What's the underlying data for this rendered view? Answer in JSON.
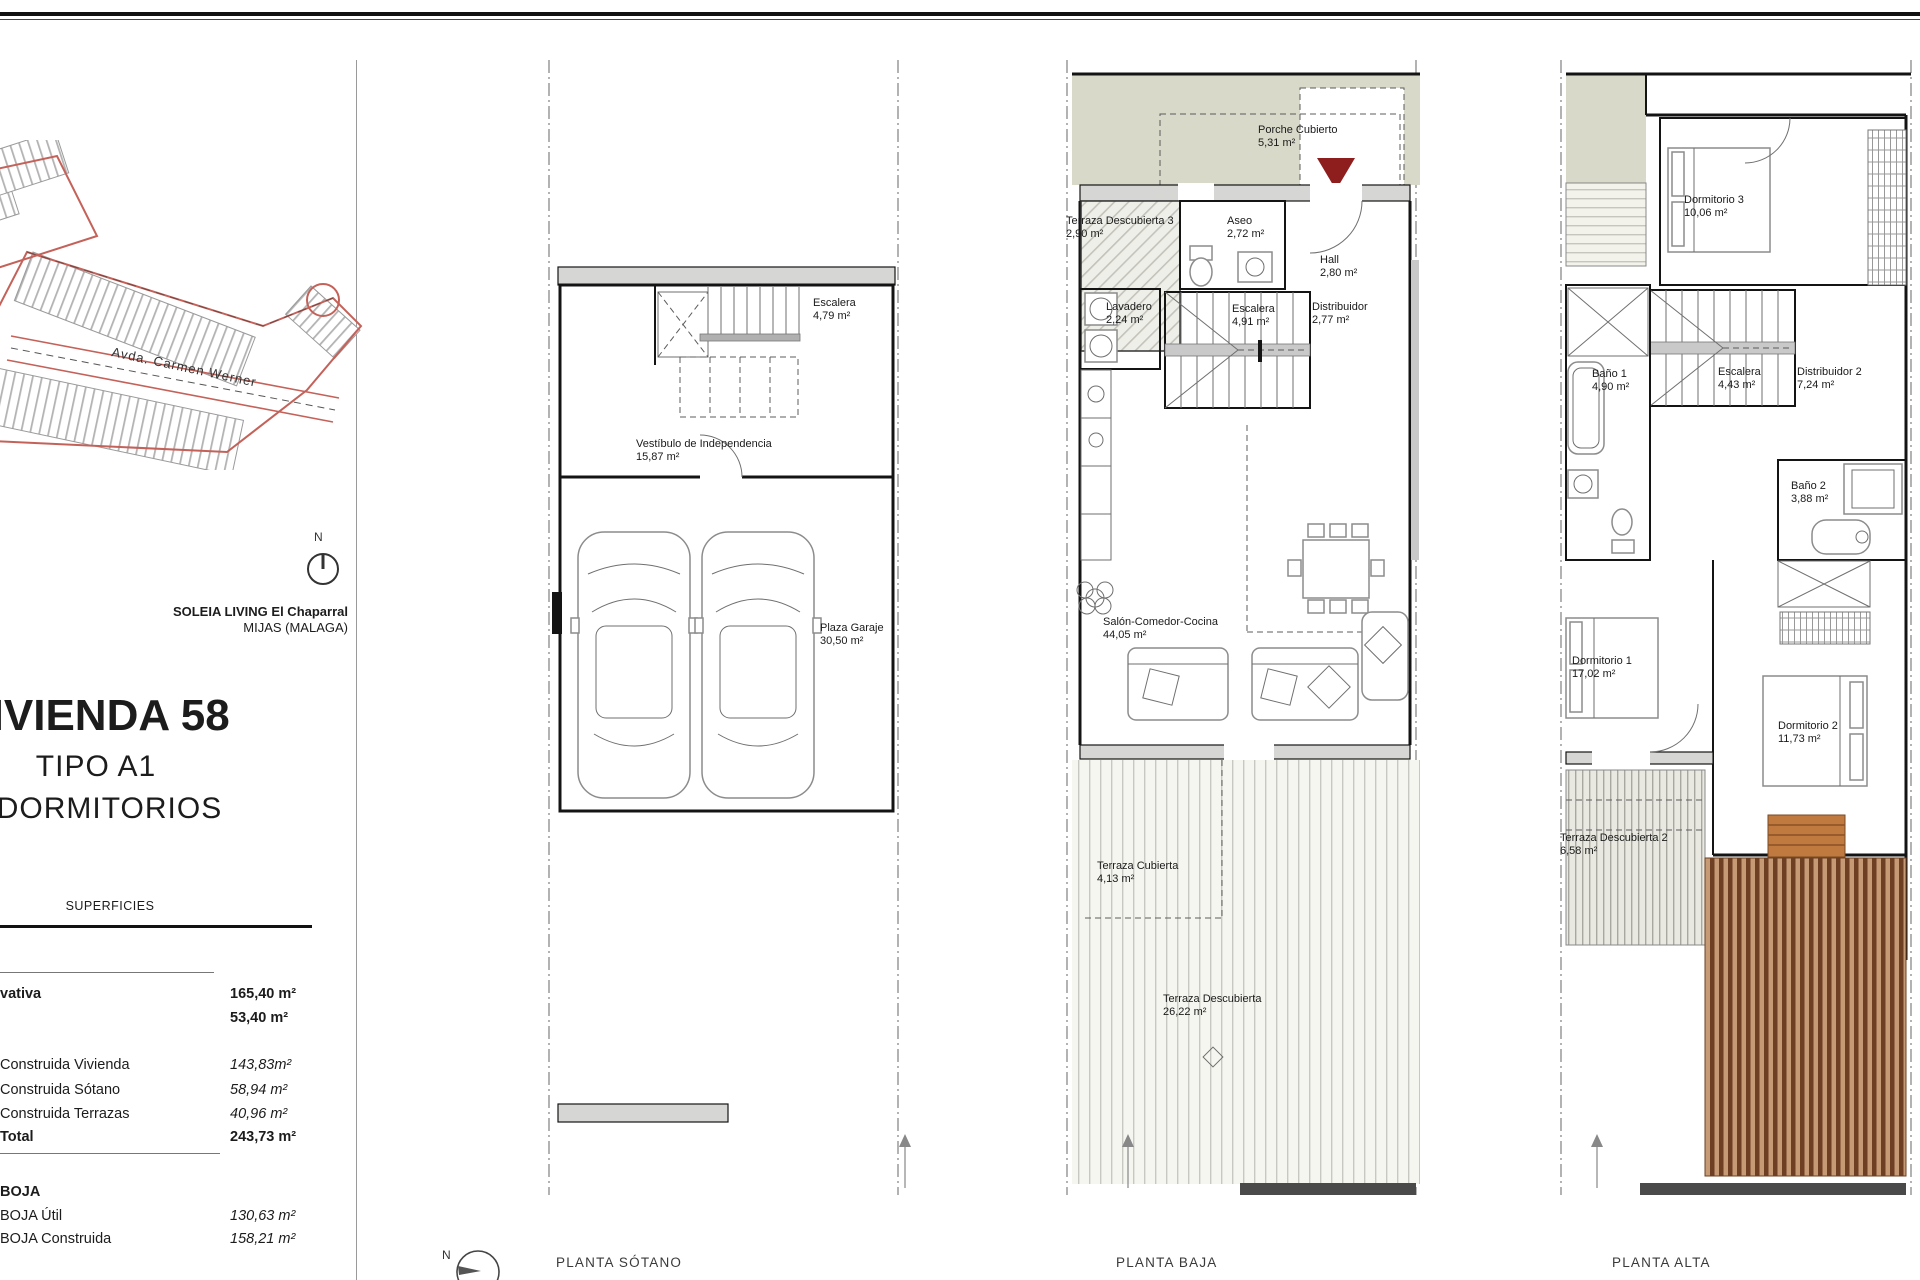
{
  "page": {
    "north_label": "N",
    "street_label": "Avda. Carmen Werner",
    "project_name": "SOLEIA LIVING El Chaparral",
    "project_location": "MIJAS (MALAGA)",
    "sheet_title": "VIVIENDA 58",
    "sheet_type": "TIPO A1",
    "sheet_bedrooms": "3 DORMITORIOS"
  },
  "superficies": {
    "header": "SUPERFICIES",
    "rows": [
      {
        "label": "vativa",
        "value": "165,40 m²"
      },
      {
        "label": "",
        "value": "53,40 m²"
      },
      {
        "label": "Construida Vivienda",
        "value": "143,83m²"
      },
      {
        "label": "Construida Sótano",
        "value": "58,94 m²"
      },
      {
        "label": "Construida Terrazas",
        "value": "40,96 m²"
      },
      {
        "label": "Total",
        "value": "243,73 m²"
      },
      {
        "label": "BOJA",
        "value": ""
      },
      {
        "label": "BOJA Útil",
        "value": "130,63 m²"
      },
      {
        "label": "BOJA Construida",
        "value": "158,21 m²"
      }
    ]
  },
  "plans": {
    "sotano": {
      "title": "PLANTA SÓTANO",
      "rooms": [
        {
          "name": "Escalera",
          "area": "4,79 m²"
        },
        {
          "name": "Vestíbulo de Independencia",
          "area": "15,87 m²"
        },
        {
          "name": "Plaza Garaje",
          "area": "30,50 m²"
        }
      ]
    },
    "baja": {
      "title": "PLANTA BAJA",
      "rooms": [
        {
          "name": "Porche Cubierto",
          "area": "5,31 m²"
        },
        {
          "name": "Terraza Descubierta 3",
          "area": "2,90 m²"
        },
        {
          "name": "Aseo",
          "area": "2,72 m²"
        },
        {
          "name": "Hall",
          "area": "2,80 m²"
        },
        {
          "name": "Lavadero",
          "area": "2,24 m²"
        },
        {
          "name": "Escalera",
          "area": "4,91 m²"
        },
        {
          "name": "Distribuidor",
          "area": "2,77 m²"
        },
        {
          "name": "Salón-Comedor-Cocina",
          "area": "44,05 m²"
        },
        {
          "name": "Terraza Cubierta",
          "area": "4,13 m²"
        },
        {
          "name": "Terraza Descubierta",
          "area": "26,22 m²"
        }
      ]
    },
    "alta": {
      "title": "PLANTA ALTA",
      "rooms": [
        {
          "name": "Dormitorio 3",
          "area": "10,06 m²"
        },
        {
          "name": "Baño 1",
          "area": "4,90 m²"
        },
        {
          "name": "Escalera",
          "area": "4,43 m²"
        },
        {
          "name": "Distribuidor 2",
          "area": "7,24 m²"
        },
        {
          "name": "Baño 2",
          "area": "3,88 m²"
        },
        {
          "name": "Dormitorio 1",
          "area": "17,02 m²"
        },
        {
          "name": "Dormitorio 2",
          "area": "11,73 m²"
        },
        {
          "name": "Terraza Descubierta 2",
          "area": "6,58 m²"
        }
      ]
    }
  }
}
